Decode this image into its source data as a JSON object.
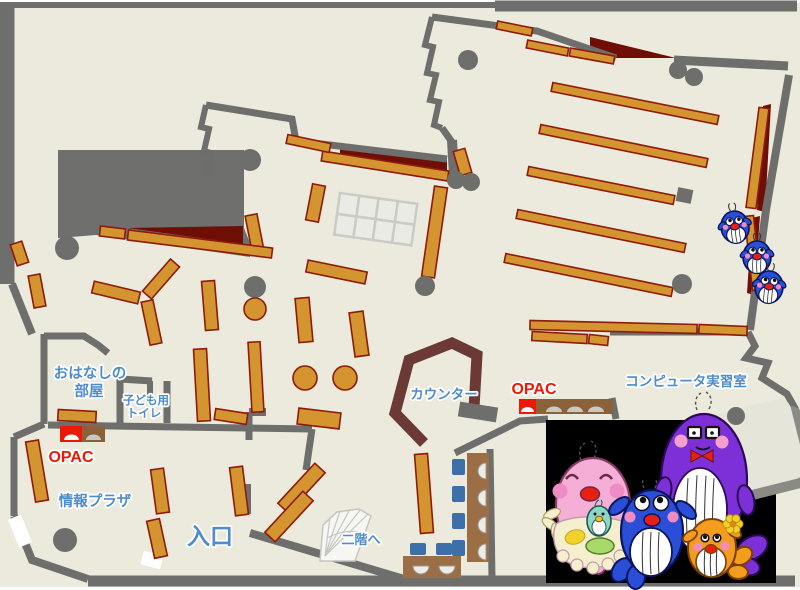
{
  "page": {
    "type": "library-floor-map",
    "description": "library first floor guide map"
  },
  "labels": [
    {
      "id": "ohanashi-line1",
      "text": "おはなしの",
      "x": 90,
      "y": 378,
      "size": 14.5,
      "color": "blue"
    },
    {
      "id": "ohanashi-line2",
      "text": "部屋",
      "x": 89,
      "y": 396,
      "size": 14.5,
      "color": "blue"
    },
    {
      "id": "toilet-line1",
      "text": "子ども用",
      "x": 146,
      "y": 404,
      "size": 11.5,
      "color": "blue"
    },
    {
      "id": "toilet-line2",
      "text": "トイレ",
      "x": 144,
      "y": 417,
      "size": 11.5,
      "color": "blue"
    },
    {
      "id": "opac-left",
      "text": "OPAC",
      "x": 71,
      "y": 462,
      "size": 16,
      "color": "red"
    },
    {
      "id": "joho-plaza",
      "text": "情報プラザ",
      "x": 95,
      "y": 506,
      "size": 14.5,
      "color": "blue"
    },
    {
      "id": "entrance",
      "text": "入口",
      "x": 210,
      "y": 544,
      "size": 23,
      "color": "blue"
    },
    {
      "id": "to-second-floor",
      "text": "二階へ",
      "x": 361,
      "y": 544,
      "size": 13,
      "color": "blue"
    },
    {
      "id": "counter",
      "text": "カウンター",
      "x": 444,
      "y": 399,
      "size": 13.5,
      "color": "blue"
    },
    {
      "id": "opac-right",
      "text": "OPAC",
      "x": 534,
      "y": 394,
      "size": 16,
      "color": "red"
    },
    {
      "id": "computer-room",
      "text": "コンピュータ実習室",
      "x": 686,
      "y": 386,
      "size": 13.5,
      "color": "blue"
    }
  ],
  "colors": {
    "floor": "#ebeadc",
    "wall": "#6e6e6c",
    "blocked_area": "#6f6f6d",
    "shelf": "#d49531",
    "shelf_border": "#8e1b0b",
    "shadow_red": "#6f0e05",
    "counter": "#6b3a37",
    "desk": "#9c6e45",
    "chair": "#3d6fa8",
    "label_blue": "#4f8ccd",
    "label_red": "#ec1808",
    "opac_red": "#ec1808",
    "opac_station": "#8a6138",
    "grid_fill": "#ebebe6",
    "grid_line": "#cbcbc5",
    "stairs_fill": "#f6f6f2",
    "stairs_line": "#c6c6c1",
    "door_white": "#ffffff",
    "kiosk_light": "#e6e5da",
    "kiosk_shadow": "#8b8b85",
    "mascot_bg": "#000000",
    "whale_blue": "#2a4fd6",
    "whale_pink": "#f5afd7",
    "whale_purple": "#7d2fd8",
    "whale_orange": "#f39c1e",
    "whale_teal": "#8cd8c4",
    "cheek_pink": "#f08cc0",
    "mouth_red": "#e82012",
    "apron_cream": "#f6efce",
    "cushion_green": "#a8d96a",
    "flower_yellow": "#f2d228"
  },
  "mascots": {
    "family_scene": [
      "pink-mother-whale-with-baby",
      "blue-child-whale",
      "purple-father-whale",
      "orange-child-whale"
    ],
    "right_edge": "three-small-blue-whales"
  }
}
